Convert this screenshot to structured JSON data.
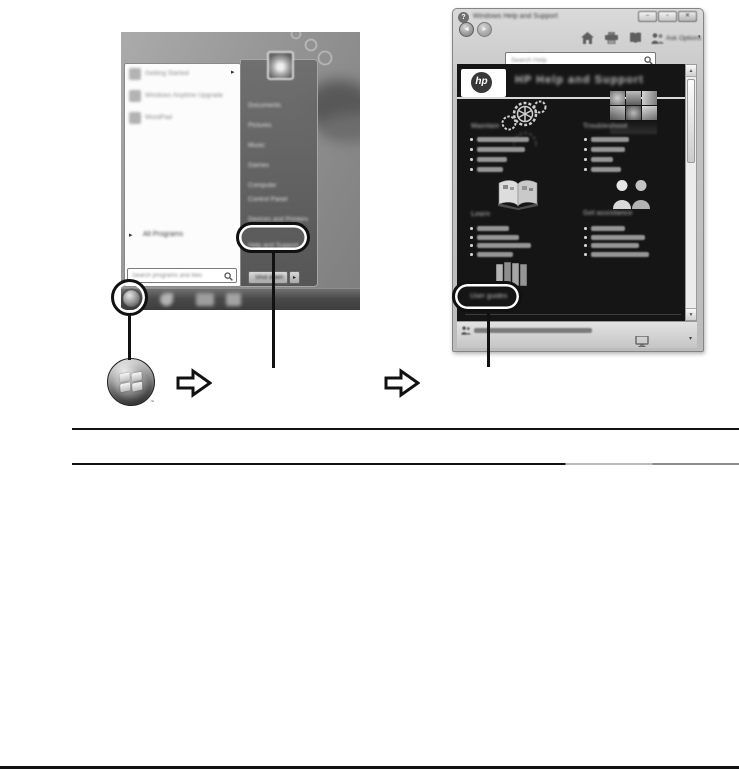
{
  "start_screenshot": {
    "programs": [
      {
        "label": "Getting Started"
      },
      {
        "label": "Windows Anytime Upgrade"
      },
      {
        "label": "WordPad"
      }
    ],
    "all_programs_label": "All Programs",
    "search_placeholder": "Search programs and files",
    "menu_items": [
      "Documents",
      "Pictures",
      "Music",
      "Games",
      "Computer",
      "Control Panel",
      "Devices and Printers",
      "Help and Support"
    ],
    "shut_down_label": "Shut down"
  },
  "help_window": {
    "window_title": "Windows Help and Support",
    "help_badge": "?",
    "search_placeholder": "Search Help",
    "toolbar": {
      "ask_label": "Ask",
      "options_label": "Options"
    },
    "banner": {
      "logo_text": "hp",
      "title": "HP Help and Support"
    },
    "sections": [
      {
        "heading": "Maintain"
      },
      {
        "heading": "Troubleshoot"
      },
      {
        "heading": "Learn"
      },
      {
        "heading": "Get assistance"
      }
    ],
    "user_guides_label": "User guides"
  },
  "glyphs": {
    "submenu": "▸",
    "dropdown": "▾",
    "scroll_up": "▲",
    "scroll_down": "▼",
    "minimize": "–",
    "maximize": "▫",
    "close": "✕",
    "back": "◄",
    "forward": "►",
    "trademark": "™"
  },
  "colors": {
    "annotation": "#111111",
    "content_bg": "#151515",
    "chrome_gray": "#c3c3c3"
  }
}
